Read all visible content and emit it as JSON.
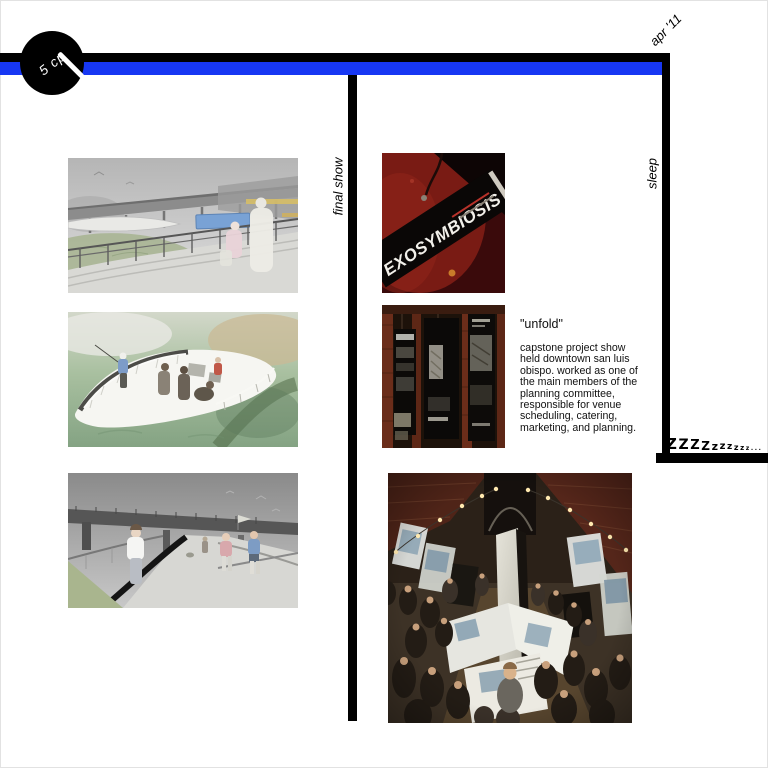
{
  "header": {
    "badge_label": "5 cp",
    "date_label": "apr '11"
  },
  "sections": {
    "left_label": "final show",
    "right_label": "sleep"
  },
  "sleep_graphic": {
    "zzz_chars": [
      "Z",
      "Z",
      "Z",
      "Z",
      "z",
      "z",
      "z",
      "z",
      "z",
      "z",
      ".",
      ".",
      "."
    ]
  },
  "poster": {
    "title": "EXOSYMBIOSIS"
  },
  "unfold": {
    "title": "\"unfold\"",
    "body": "capstone project show held downtown san luis obispo. worked as one of the main members of the planning committee, responsible for venue scheduling, catering, marketing, and planning."
  },
  "colors": {
    "accent_blue": "#1737f3",
    "line_black": "#000000",
    "poster_red": "#5a1010",
    "brick": "#6b2d1a"
  }
}
